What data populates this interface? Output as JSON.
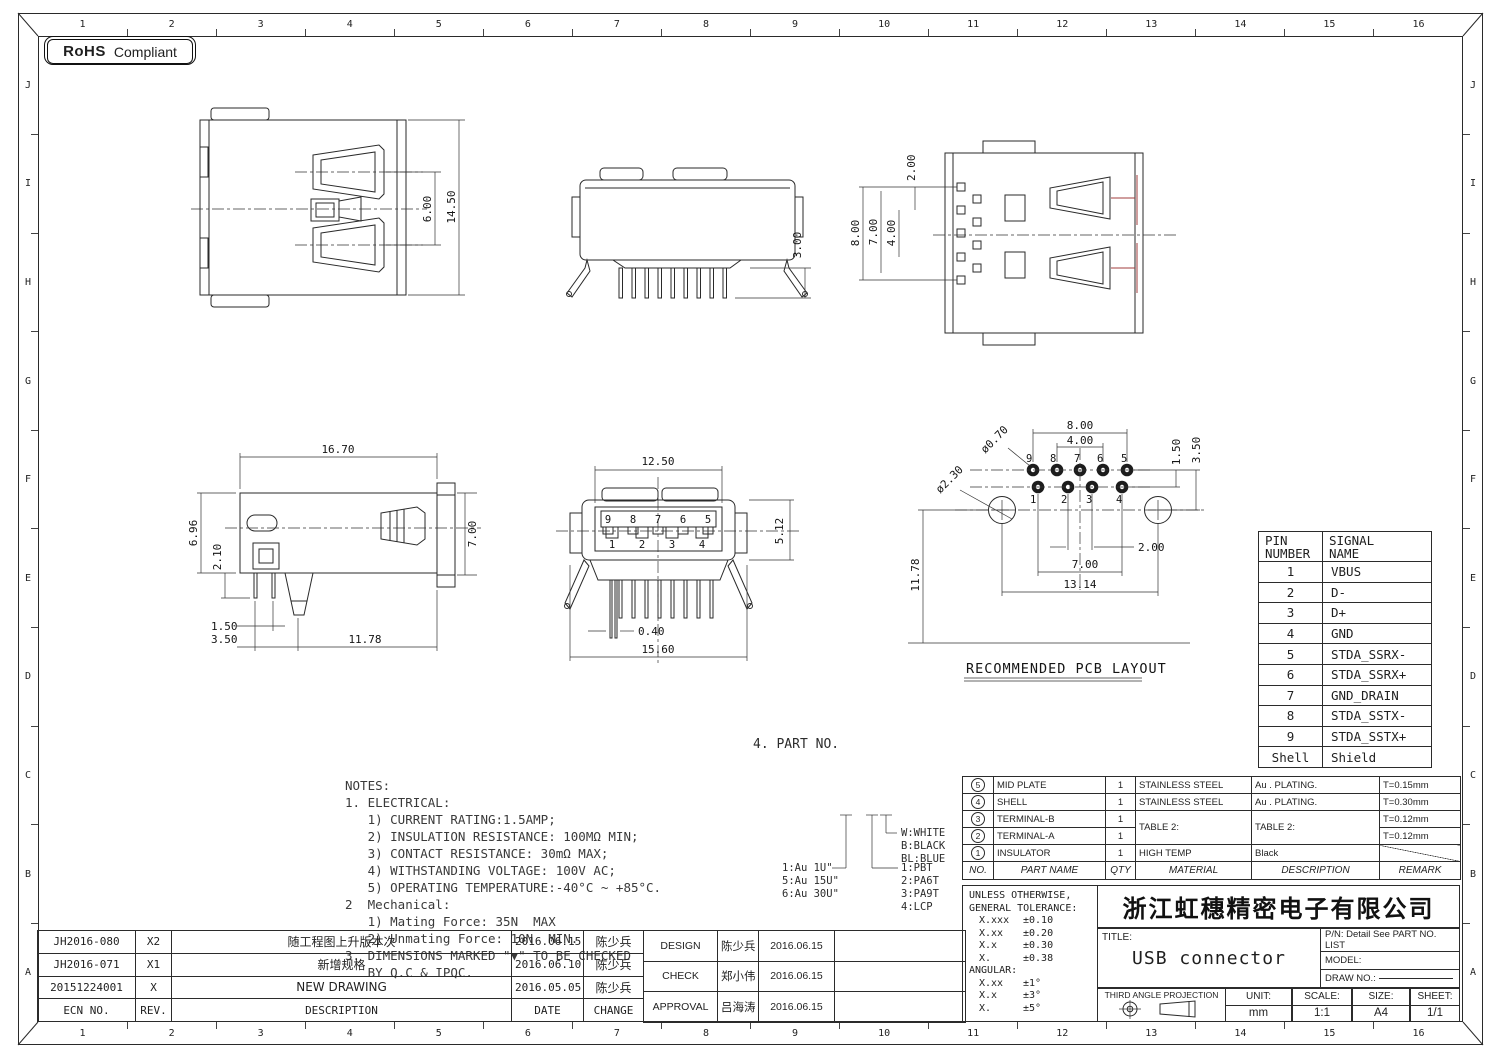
{
  "colors": {
    "ink": "#2a2a2a",
    "red": "#a23c3c",
    "bg": "#ffffff"
  },
  "badge": {
    "bold": "RoHS",
    "rest": "Compliant"
  },
  "grid": {
    "cols": [
      "1",
      "2",
      "3",
      "4",
      "5",
      "6",
      "7",
      "8",
      "9",
      "10",
      "11",
      "12",
      "13",
      "14",
      "15",
      "16"
    ],
    "rows": [
      "J",
      "I",
      "H",
      "G",
      "F",
      "E",
      "D",
      "C",
      "B",
      "A"
    ]
  },
  "views": {
    "top": {
      "d6": "6.00",
      "d145": "14.50"
    },
    "rear": {
      "d3": "3.00"
    },
    "bottom": {
      "d2": "2.00",
      "d8": "8.00",
      "d7": "7.00",
      "d4": "4.00"
    },
    "side": {
      "d167": "16.70",
      "d696": "6.96",
      "d21": "2.10",
      "d7": "7.00",
      "d15": "1.50",
      "d35": "3.50",
      "d1178": "11.78"
    },
    "front": {
      "d125": "12.50",
      "d512": "5.12",
      "d04": "0.40",
      "d156": "15.60",
      "pins_top": [
        "9",
        "8",
        "7",
        "6",
        "5"
      ],
      "pins_bottom": [
        "1",
        "2",
        "3",
        "4"
      ]
    },
    "pcb": {
      "title": "RECOMMENDED PCB LAYOUT",
      "d8": "8.00",
      "d4": "4.00",
      "d15": "1.50",
      "d35": "3.50",
      "dia_small": "ø0.70",
      "dia_big": "ø2.30",
      "d2": "2.00",
      "d7": "7.00",
      "d1314": "13.14",
      "d1178": "11.78",
      "pins_top": [
        "9",
        "8",
        "7",
        "6",
        "5"
      ],
      "pins_bottom": [
        "1",
        "2",
        "3",
        "4"
      ]
    }
  },
  "pin_table": {
    "h1a": "PIN",
    "h1b": "NUMBER",
    "h2a": "SIGNAL",
    "h2b": "NAME",
    "rows": [
      [
        "1",
        "VBUS"
      ],
      [
        "2",
        "D-"
      ],
      [
        "3",
        "D+"
      ],
      [
        "4",
        "GND"
      ],
      [
        "5",
        "STDA_SSRX-"
      ],
      [
        "6",
        "STDA_SSRX+"
      ],
      [
        "7",
        "GND_DRAIN"
      ],
      [
        "8",
        "STDA_SSTX-"
      ],
      [
        "9",
        "STDA_SSTX+"
      ],
      [
        "Shell",
        "Shield"
      ]
    ]
  },
  "notes": {
    "lines": [
      "NOTES:",
      "1. ELECTRICAL:",
      "   1) CURRENT RATING:1.5AMP;",
      "   2) INSULATION RESISTANCE: 100MΩ MIN;",
      "   3) CONTACT RESISTANCE: 30mΩ MAX;",
      "   4) WITHSTANDING VOLTAGE: 100V AC;",
      "   5) OPERATING TEMPERATURE:-40°C ~ +85°C.",
      "2  Mechanical:",
      "   1) Mating Force: 35N  MAX",
      "   2) Unmating Force: 10N  MIN.",
      "3. DIMENSIONS MARKED \"▼\" TO BE CHECKED",
      "   BY Q.C & IPQC."
    ]
  },
  "part_no": {
    "heading": "4. PART NO.",
    "plating": [
      "1:Au 1U\"",
      "5:Au 15U\"",
      "6:Au 30U\""
    ],
    "shell_colors": [
      "W:WHITE",
      "B:BLACK",
      "BL:BLUE"
    ],
    "materials": [
      "1:PBT",
      "2:PA6T",
      "3:PA9T",
      "4:LCP"
    ]
  },
  "bom": {
    "headers": [
      "NO.",
      "PART NAME",
      "QTY",
      "MATERIAL",
      "DESCRIPTION",
      "REMARK"
    ],
    "rows": [
      {
        "no": "5",
        "name": "MID PLATE",
        "qty": "1",
        "mat": "STAINLESS STEEL",
        "desc": "Au . PLATING.",
        "remark": "T=0.15mm"
      },
      {
        "no": "4",
        "name": "SHELL",
        "qty": "1",
        "mat": "STAINLESS STEEL",
        "desc": "Au . PLATING.",
        "remark": "T=0.30mm"
      },
      {
        "no": "3",
        "name": "TERMINAL-B",
        "qty": "1",
        "mat": "TABLE 2:",
        "desc": "TABLE 2:",
        "remark": "T=0.12mm"
      },
      {
        "no": "2",
        "name": "TERMINAL-A",
        "qty": "1",
        "mat": "",
        "desc": "",
        "remark": "T=0.12mm"
      },
      {
        "no": "1",
        "name": "INSULATOR",
        "qty": "1",
        "mat": "HIGH TEMP",
        "desc": "Black",
        "remark": ""
      }
    ]
  },
  "tolerance": {
    "l1": "UNLESS OTHERWISE,",
    "l2": "GENERAL TOLERANCE:",
    "rows": [
      [
        "X.xxx",
        "±0.10"
      ],
      [
        "X.xx",
        "±0.20"
      ],
      [
        "X.x",
        "±0.30"
      ],
      [
        "X.",
        "±0.38"
      ]
    ],
    "angular_label": "ANGULAR:",
    "angular": [
      [
        "X.xx",
        "±1°"
      ],
      [
        "X.x",
        "±3°"
      ],
      [
        "X.",
        "±5°"
      ]
    ]
  },
  "title_block": {
    "company": "浙江虹穗精密电子有限公司",
    "title_label": "TITLE:",
    "title": "USB connector",
    "pn": "P/N: Detail See PART NO. LIST",
    "model_label": "MODEL:",
    "draw_label": "DRAW NO.:",
    "projection": "THIRD ANGLE PROJECTION",
    "unit_label": "UNIT:",
    "unit": "mm",
    "scale_label": "SCALE:",
    "scale": "1:1",
    "size_label": "SIZE:",
    "size": "A4",
    "sheet_label": "SHEET:",
    "sheet": "1/1"
  },
  "revisions": {
    "headers": [
      "ECN NO.",
      "REV.",
      "DESCRIPTION",
      "DATE",
      "CHANGE"
    ],
    "rows": [
      [
        "JH2016-080",
        "X2",
        "随工程图上升版本次",
        "2016.06.15",
        "陈少兵"
      ],
      [
        "JH2016-071",
        "X1",
        "新增规格",
        "2016.06.10",
        "陈少兵"
      ],
      [
        "20151224001",
        "X",
        "NEW DRAWING",
        "2016.05.05",
        "陈少兵"
      ]
    ]
  },
  "approvals": {
    "rows": [
      [
        "DESIGN",
        "陈少兵",
        "2016.06.15"
      ],
      [
        "CHECK",
        "郑小伟",
        "2016.06.15"
      ],
      [
        "APPROVAL",
        "吕海涛",
        "2016.06.15"
      ]
    ]
  }
}
